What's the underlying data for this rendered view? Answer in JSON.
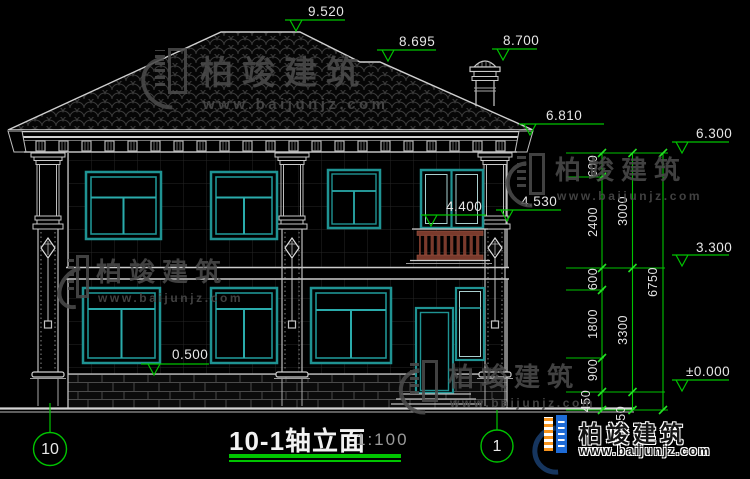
{
  "drawing_title": {
    "name": "10-1轴立面",
    "scale": "1:100"
  },
  "axes": {
    "left": "10",
    "right": "1"
  },
  "levels": {
    "ridge": "9.520",
    "sub_ridge": "8.695",
    "chimney": "8.700",
    "eave": "6.810",
    "top_of_wall": "6.300",
    "balcony_inner": "4.400",
    "balcony_outer": "4.530",
    "floor2": "3.300",
    "sill": "0.500",
    "ground": "±0.000"
  },
  "dim_chains": {
    "inner": [
      "600",
      "2400",
      "600",
      "1800",
      "900",
      "450"
    ],
    "middle": [
      "3000",
      "3300",
      "450"
    ],
    "total": "6750"
  },
  "watermark": {
    "brand": "柏竣建筑",
    "url": "www.baijunjz.com"
  },
  "logo": {
    "brand": "柏竣建筑",
    "url": "www.baijunjz.com"
  },
  "colors": {
    "annotation_green": "#00c400",
    "window_teal": "#1f9393",
    "railing_red": "#7a3a2c",
    "logo_blue": "#1e6bd6",
    "logo_orange": "#f7941d"
  }
}
